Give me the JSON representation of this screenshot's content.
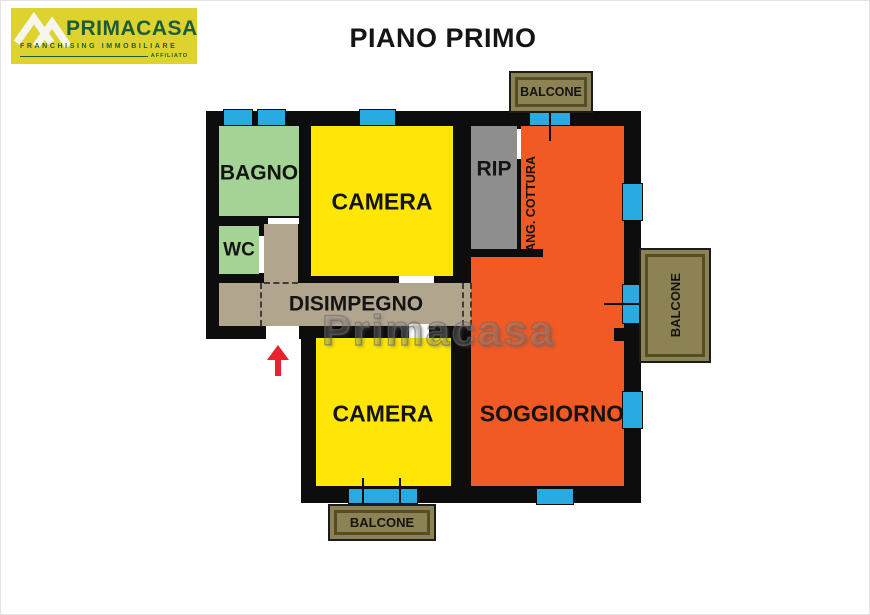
{
  "header": {
    "title": "PIANO PRIMO"
  },
  "logo": {
    "brand": "PRIMACASA",
    "tagline": "FRANCHISING IMMOBILIARE",
    "affiliate": "AFFILIATO",
    "icon": "house-roofs-icon"
  },
  "watermark": "Primacasa",
  "floorplan": {
    "rooms": {
      "bagno": "BAGNO",
      "wc": "WC",
      "camera_top": "CAMERA",
      "rip": "RIP",
      "ang_cottura": "ANG. COTTURA",
      "disimpegno": "DISIMPEGNO",
      "camera_bottom": "CAMERA",
      "soggiorno": "SOGGIORNO"
    },
    "balconies": {
      "top": "BALCONE",
      "right": "BALCONE",
      "bottom": "BALCONE"
    },
    "entrance": "entrance-arrow"
  },
  "colors": {
    "wall": "#0d0d0d",
    "room-yellow": "#ffe606",
    "room-orange": "#f15a25",
    "room-green": "#a5d295",
    "room-gray": "#8e8e8e",
    "room-tan": "#b2a58d",
    "balcony-fill": "#8d8254",
    "balcony-line": "#554d26",
    "window-blue": "#29abe2",
    "arrow-red": "#e8232b",
    "logo-yellow": "#ddd22e",
    "logo-green": "#1d5c38"
  }
}
